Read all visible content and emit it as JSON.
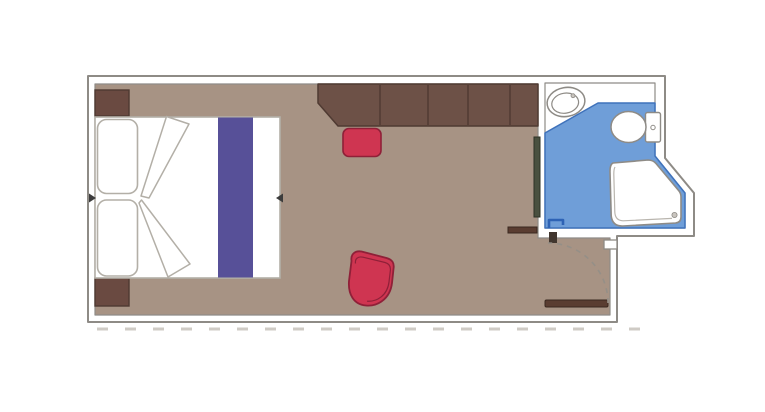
{
  "page": {
    "background": "#ffffff",
    "kind": "cabin-floor-plan"
  },
  "colors": {
    "wall_line": "#8e8b86",
    "wall_fill": "#ffffff",
    "floor": "#a79384",
    "furniture_brown": "#6d5147",
    "furniture_brown_outline": "#4f3a32",
    "nightstand_brown": "#6a4a41",
    "accent_red": "#cf3551",
    "accent_red_outline": "#8f2038",
    "runner_purple": "#575098",
    "bed_white": "#ffffff",
    "bed_outline": "#b3afa7",
    "bathroom_blue": "#6f9ed8",
    "bathroom_blue_line": "#3f72bb",
    "door_mark_blue": "#2e63b5",
    "fixture_dark": "#49503f",
    "fixture_dark_outline": "#2d3226",
    "door_brown": "#5a3d31",
    "door_brown_outline": "#3a281f",
    "jamb_dark": "#41362e",
    "swing_line": "#958f87",
    "corridor_dash": "#cfcbc5",
    "arrow_dark": "#3c3c3c",
    "drain_gray": "#c9c5bf"
  },
  "floorplan": {
    "elements": [
      "outer-walls",
      "main-room-floor",
      "corridor-dashed-line",
      "double-bed",
      "pillow-top",
      "pillow-bottom",
      "duvet-fold-top",
      "duvet-fold-bottom",
      "bed-runner",
      "bed-width-arrows",
      "nightstand-top",
      "nightstand-bottom",
      "wardrobe-closet",
      "closet-dividers",
      "desk-stool",
      "armchair",
      "mirror-panel",
      "bathroom-floor",
      "washbasin",
      "toilet",
      "shower",
      "bathroom-door-mark",
      "entry-door-leaf",
      "entry-door-swing-arc",
      "door-jamb",
      "door-strike-notch",
      "wall-ledge"
    ]
  }
}
